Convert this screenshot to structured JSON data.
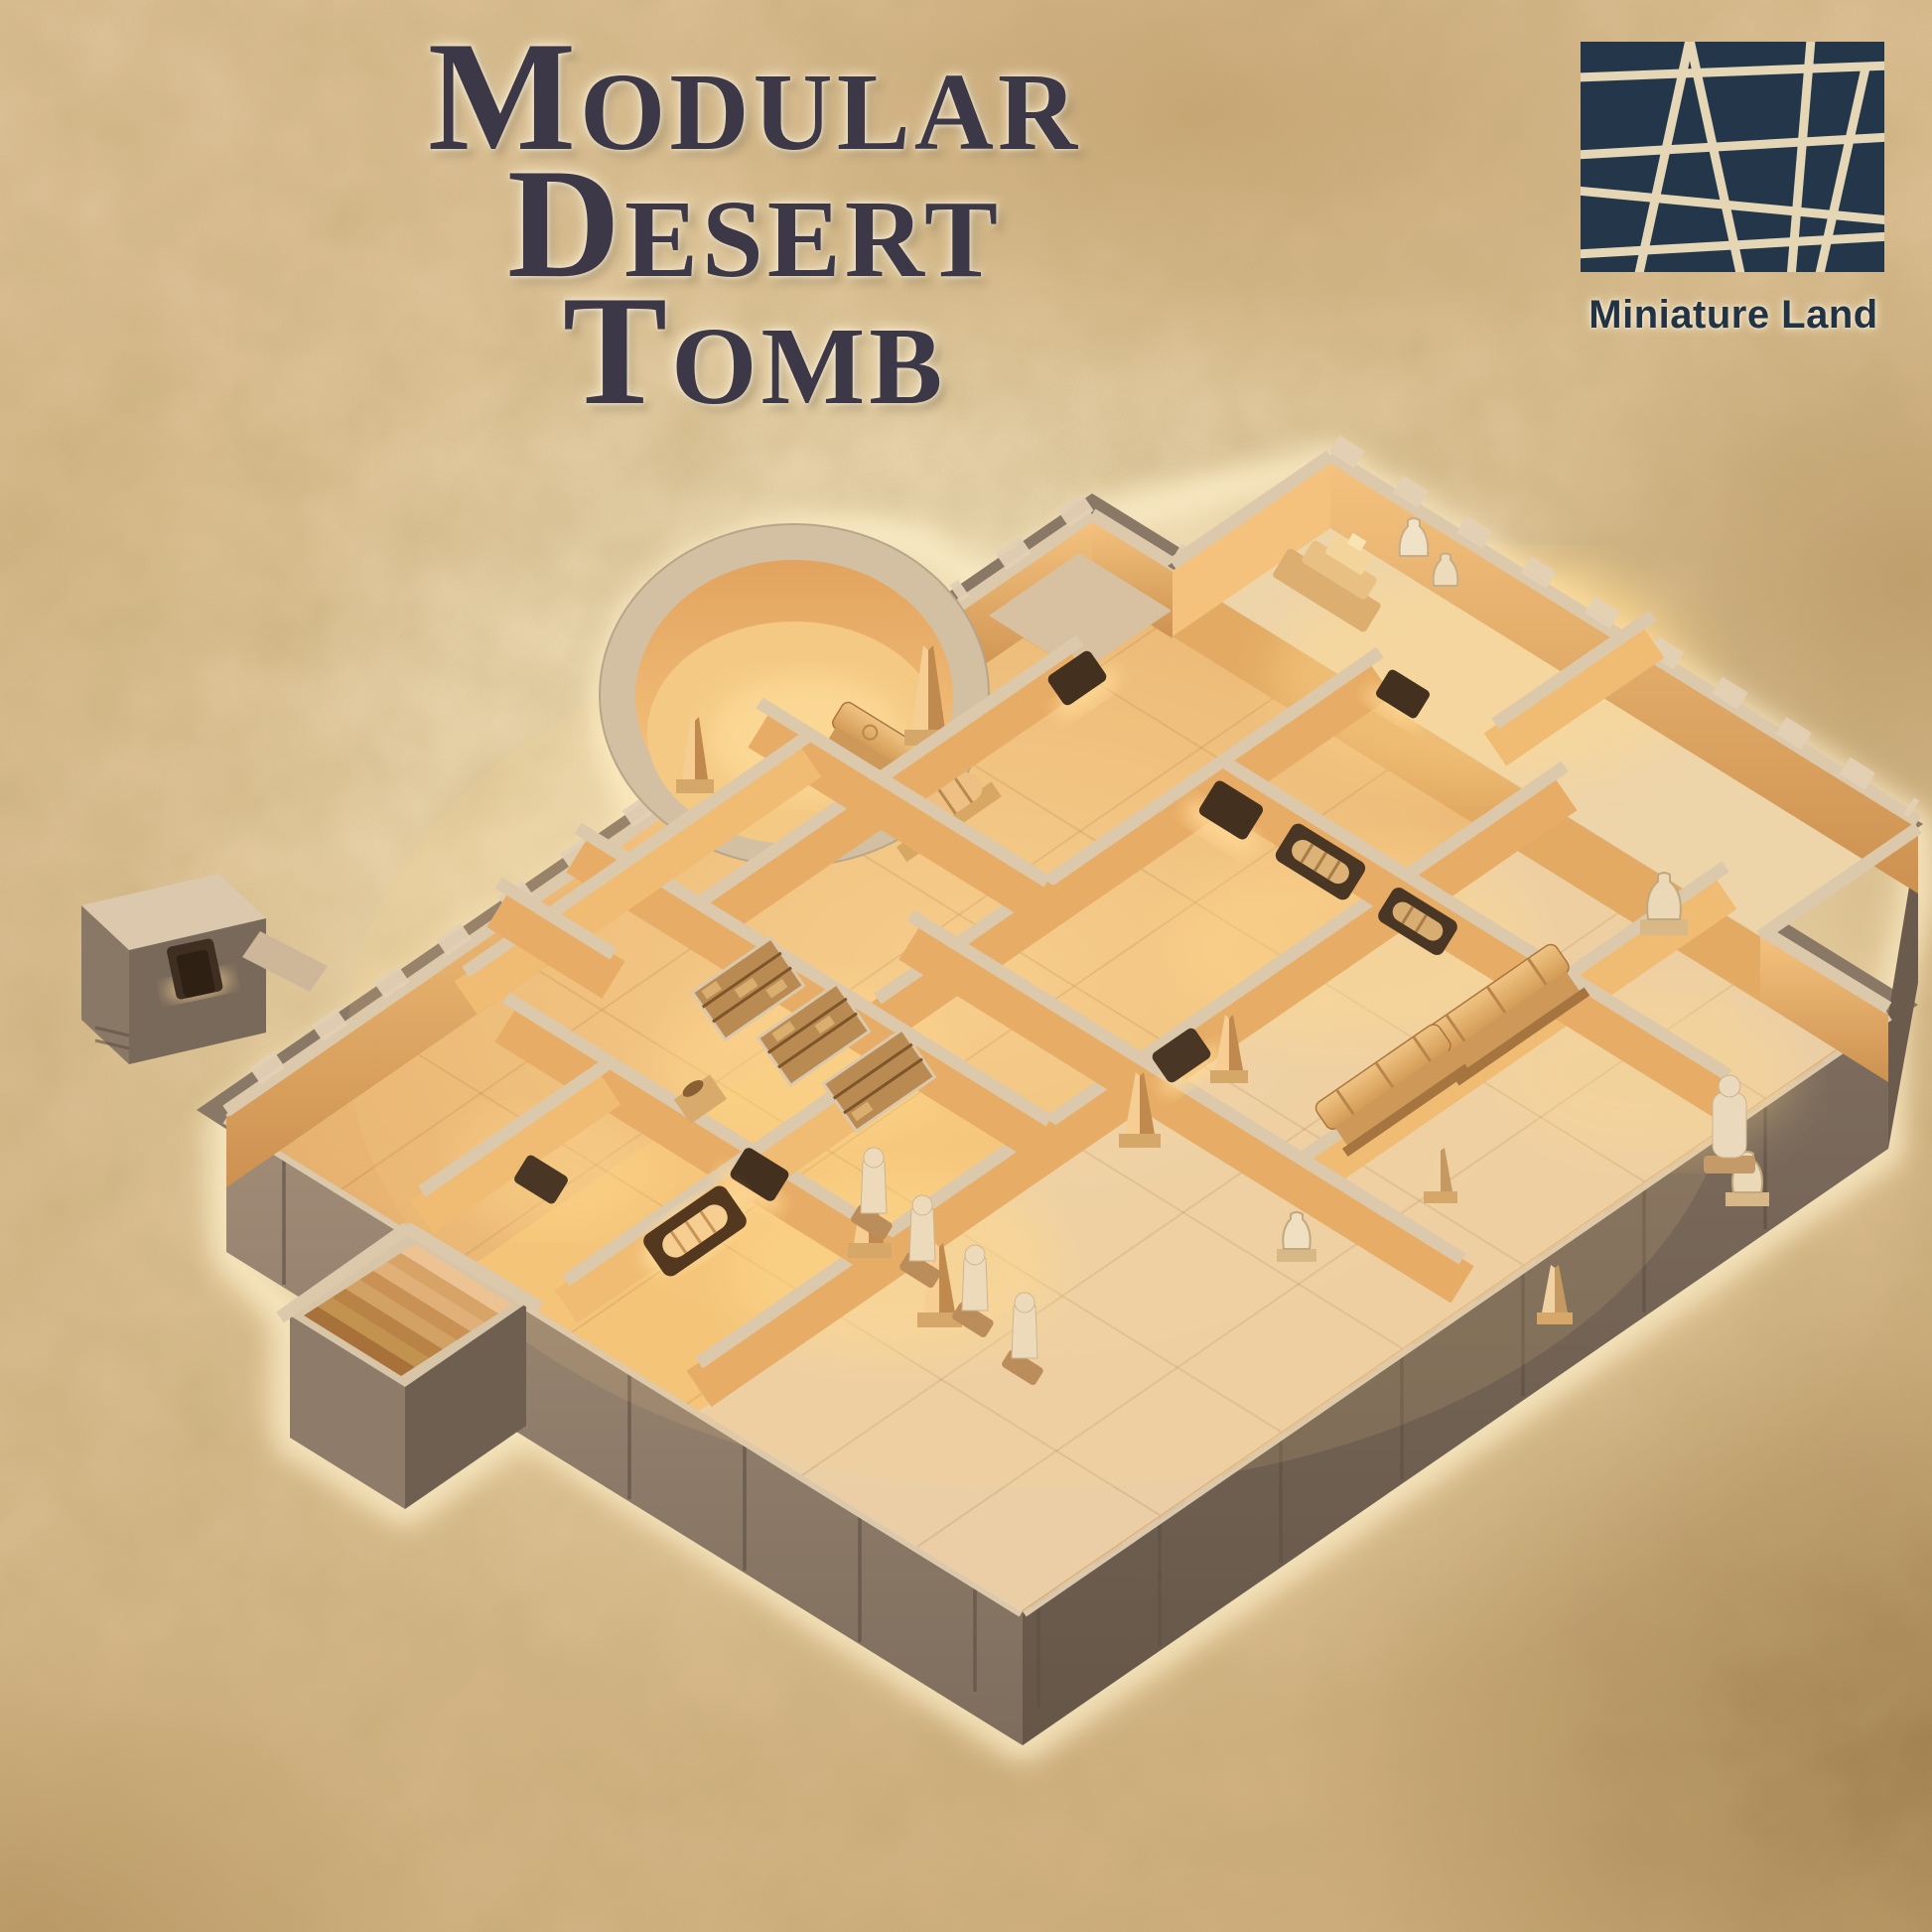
{
  "title": {
    "line1": "Modular",
    "line2": "Desert",
    "line3": "Tomb"
  },
  "brand": {
    "name": "Miniature Land"
  },
  "render": {
    "subject": "Isometric 3D render of a sand-colored modular desert tomb terrain set with warmly lit rooms, obelisks, sarcophagi, mummy niches, statues, a circular chamber, a staircase module and a separate entrance module, on an aged parchment background"
  },
  "colors": {
    "title_text": "#3c3847",
    "brand_navy": "#24364a",
    "logo_lines": "#ecdcba",
    "parchment_mid": "#ddc197",
    "parchment_corner": "#8f7347",
    "stone_top": "#dcc8ab",
    "stone_front_shadow": "#75655a",
    "interior_wall_glow": "#e7ad66",
    "floor_warm": "#f1c07c",
    "floor_pale": "#ecd3ad",
    "light_glow": "#ffd98f"
  }
}
